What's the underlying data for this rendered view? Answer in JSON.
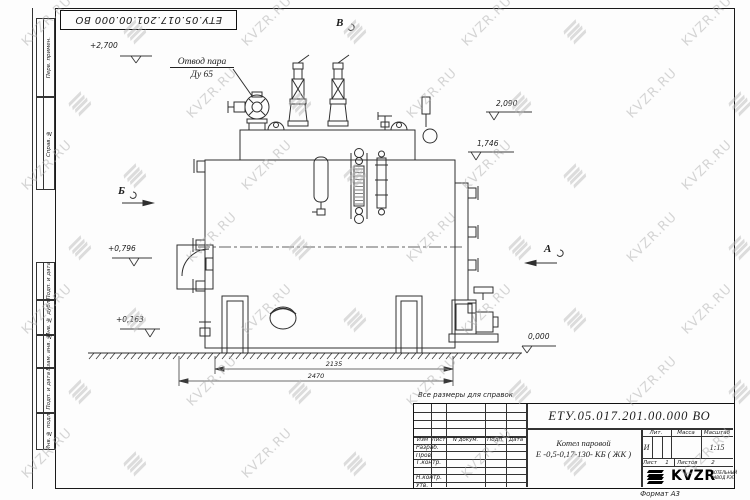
{
  "watermark": {
    "text": "KVZR.RU",
    "color": "#b5b5b5"
  },
  "top_stamp": {
    "text": "ЕТУ.05.017.201.00.000  ВО"
  },
  "margin_stamps": {
    "perv_primen": "Перв. примен.",
    "sprav_no": "Справ. №",
    "podp_data_1": "Подп. и дата",
    "inv_dubl": "Инв. № дубл.",
    "vzam_inv": "Взам. инв. №",
    "podp_data_2": "Подп. и дата",
    "inv_podl": "Инв. № подл."
  },
  "drawing": {
    "callout_steam_line1": "Отвод пара",
    "callout_steam_line2": "Ду 65",
    "view_top": "В",
    "view_left": "Б",
    "view_right": "А",
    "elev_plus2700": "+2,700",
    "elev_2090": "2,090",
    "elev_1746": "1,746",
    "elev_plus0796": "+0,796",
    "elev_plus0163": "+0,163",
    "elev_0000": "0,000",
    "dim_2135": "2135",
    "dim_2470": "2470"
  },
  "note": "Все размеры для справок",
  "title_block": {
    "doc_number": "ЕТУ.05.017.201.00.000  ВО",
    "product_line1": "Котел паровой",
    "product_line2": "Е -0,5-0,17-130- КБ ( ЖК )",
    "col_izm": "Изм",
    "col_list": "Лист",
    "col_ndokum": "N докум.",
    "col_podp": "Подп.",
    "col_data": "Дата",
    "row_razrab": "Разраб.",
    "row_prov": "Пров.",
    "row_tkontr": "Т.контр.",
    "row_nkontr": "Н.контр.",
    "row_utv": "Утв.",
    "lit_label": "Лит.",
    "lit_value": "И",
    "massa_label": "Масса",
    "masshtab_label": "Масштаб",
    "masshtab_value": "1:15",
    "list_label": "Лист",
    "list_value": "1",
    "listov_label": "Листов",
    "listov_value": "2",
    "logo_text": "KVZR",
    "logo_sub1": "КОТЕЛЬНЫЙ",
    "logo_sub2": "ЗАВОД РЭП",
    "format_label": "Формат А3"
  }
}
